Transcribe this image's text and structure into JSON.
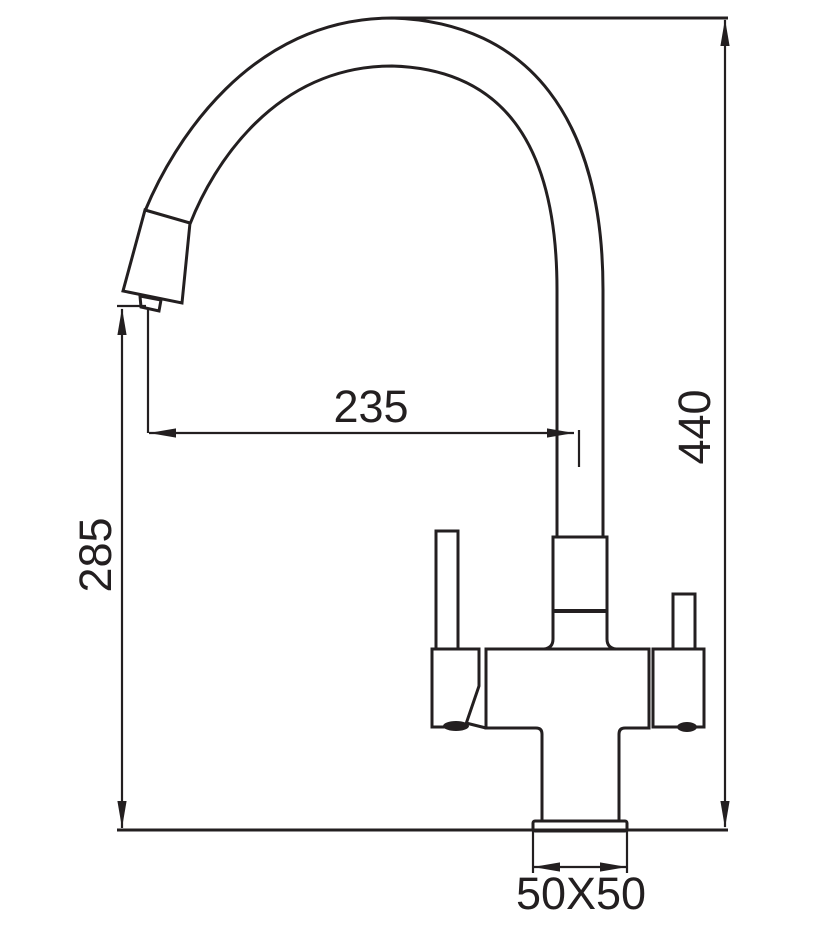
{
  "drawing": {
    "kind": "technical-dimension-drawing",
    "subject": "kitchen mixer faucet with gooseneck spout, two handles and square base, side elevation",
    "background_color": "#ffffff",
    "line_color": "#231f20",
    "dimensions": {
      "spout_reach": {
        "value": "235",
        "orientation": "horizontal"
      },
      "overall_height": {
        "value": "440",
        "orientation": "vertical"
      },
      "outlet_height": {
        "value": "285",
        "orientation": "vertical"
      },
      "base_size": {
        "value": "50X50",
        "orientation": "horizontal"
      }
    }
  }
}
